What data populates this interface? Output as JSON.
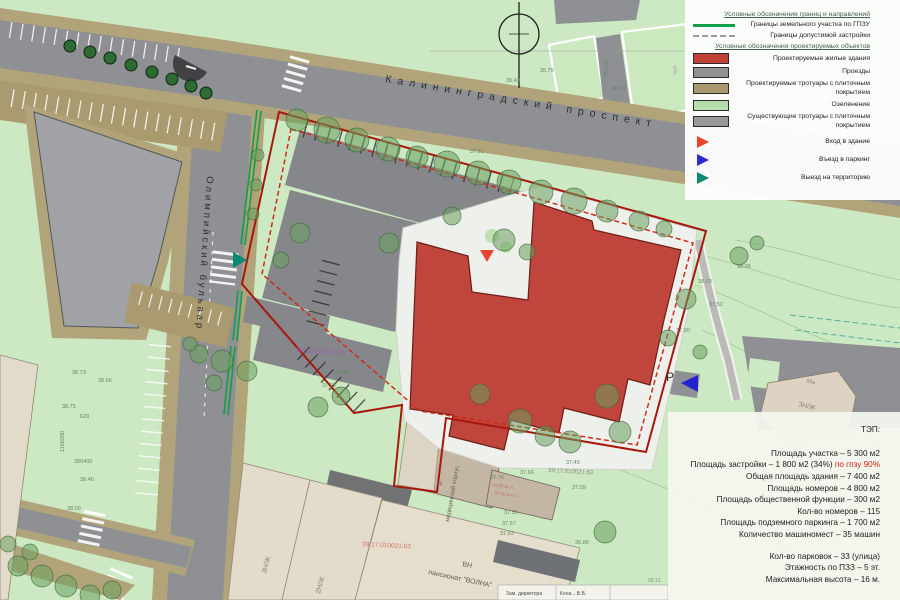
{
  "legend": {
    "header_borders": "Условные обозначения границ и направлений",
    "borders": [
      {
        "label": "Границы земельного участка по ГПЗУ",
        "swatch": "line-green",
        "name": "green-line-swatch"
      },
      {
        "label": "Границы допустимой застройки",
        "swatch": "line-dashed",
        "name": "dashed-line-swatch"
      }
    ],
    "header_objects": "Условные обозначения проектируемых объектов",
    "objects": [
      {
        "label": "Проектируемые жилые здания",
        "color": "#bf4136",
        "name": "red-building-swatch"
      },
      {
        "label": "Проезды",
        "color": "#8f9193",
        "name": "driveway-swatch"
      },
      {
        "label": "Проектируемые тротуары с плиточным покрытием",
        "color": "#a89a6f",
        "name": "new-sidewalk-swatch"
      },
      {
        "label": "Озеленение",
        "color": "#b5deac",
        "name": "greenery-swatch"
      },
      {
        "label": "Существующие тротуары с плиточным покрытием",
        "color": "#97999b",
        "name": "existing-sidewalk-swatch"
      }
    ],
    "markers": [
      {
        "label": "Вход в здание",
        "color": "#e8432c",
        "name": "building-entrance-icon"
      },
      {
        "label": "Въезд в паркинг",
        "color": "#2a2ad6",
        "name": "parking-entrance-icon"
      },
      {
        "label": "Выезд на территорию",
        "color": "#0b8a74",
        "name": "territory-exit-icon"
      }
    ]
  },
  "tep": {
    "title": "ТЭП:",
    "block1": [
      {
        "t": "Площадь участка – 5 300 м2"
      },
      {
        "t": "Площадь застройки – 1 800 м2 (34%)",
        "a": " по гпзу 90%"
      },
      {
        "t": "Общая площадь здания – 7 400 м2"
      },
      {
        "t": "Площадь номеров – 4 800 м2"
      },
      {
        "t": "Площадь общественной функции – 300 м2"
      },
      {
        "t": "Кол-во номеров – 115"
      },
      {
        "t": "Площадь подземного паркинга – 1 700 м2"
      },
      {
        "t": "Количество машиномест – 35 машин"
      }
    ],
    "block2": [
      {
        "t": "Кол-во парковок – 33 (улица)"
      },
      {
        "t": "Этажность по ПЗЗ – 5 эт."
      },
      {
        "t": "Максимальная высота – 16 м."
      }
    ]
  },
  "map": {
    "colors": {
      "background_green": "#cde9c3",
      "road_gray": "#8e9093",
      "sidewalk_tan": "#b2a47a",
      "projected_building_red": "#c0453c",
      "boundary_solid_red": "#a8170c",
      "boundary_dashed_red": "#d02a18",
      "gpzu_green_line": "#12a047"
    },
    "annotations": [
      {
        "t": "Калининградский проспект",
        "x": 385,
        "y": 82,
        "r": 9.5,
        "s": 10.5,
        "c": "#2e2e2e",
        "ls": 6
      },
      {
        "t": "Олимпийский бульвар",
        "x": 207,
        "y": 176,
        "r": 94,
        "s": 9.5,
        "c": "#2e2e2e",
        "ls": 3
      },
      {
        "t": "ВН",
        "x": 462,
        "y": 566,
        "r": 12,
        "s": 7,
        "c": "#5a5a52"
      },
      {
        "t": "пансионат \"ВОЛНА\"",
        "x": 428,
        "y": 574,
        "r": 12,
        "s": 7,
        "c": "#5a5a52"
      },
      {
        "t": "медицинский корпус",
        "x": 449,
        "y": 522,
        "r": -80,
        "s": 6,
        "c": "#6a6258"
      },
      {
        "t": "Н",
        "x": 437,
        "y": 486,
        "r": 0,
        "s": 7,
        "c": "#6a6258"
      },
      {
        "t": "3Н/Ж",
        "x": 266,
        "y": 574,
        "r": -75,
        "s": 7,
        "c": "#8a8276"
      },
      {
        "t": "2Н/Ж",
        "x": 320,
        "y": 594,
        "r": -75,
        "s": 7,
        "c": "#8a8276"
      },
      {
        "t": "3Н/Ж",
        "x": 798,
        "y": 406,
        "r": 14,
        "s": 7,
        "c": "#8a8276"
      },
      {
        "t": "68а",
        "x": 806,
        "y": 382,
        "r": 14,
        "s": 5.5,
        "c": "#8a8276"
      },
      {
        "t": "77о",
        "x": 672,
        "y": 66,
        "r": 75,
        "s": 5,
        "c": "#8a8276"
      },
      {
        "t": "P",
        "x": 666,
        "y": 381,
        "r": 0,
        "s": 12,
        "c": "#2d2d2d"
      },
      {
        "t": "39:17:010021:63",
        "x": 296,
        "y": 352,
        "r": 3,
        "s": 6.5,
        "c": "#a05cb5"
      },
      {
        "t": "39:17:010021:63",
        "x": 362,
        "y": 546,
        "r": 3,
        "s": 6.5,
        "c": "#cf7468"
      },
      {
        "t": "39:17:010021:63",
        "x": 548,
        "y": 472,
        "r": 3,
        "s": 6,
        "c": "#8b8b85"
      },
      {
        "t": "кар 200",
        "x": 606,
        "y": 78,
        "r": -83,
        "s": 5,
        "c": "#5f8760"
      },
      {
        "t": "35.79",
        "x": 540,
        "y": 72,
        "s": 5.5,
        "c": "#5f8760"
      },
      {
        "t": "35.43",
        "x": 506,
        "y": 82,
        "s": 5.5,
        "c": "#5f8760"
      },
      {
        "t": "38.21",
        "x": 612,
        "y": 90,
        "s": 5.5,
        "c": "#5f8760"
      },
      {
        "t": "37.31",
        "x": 470,
        "y": 153,
        "s": 5.5,
        "c": "#5f8760"
      },
      {
        "t": "38.06",
        "x": 737,
        "y": 268,
        "s": 5.5,
        "c": "#5f8760"
      },
      {
        "t": "38.03",
        "x": 698,
        "y": 283,
        "s": 5.5,
        "c": "#5f8760"
      },
      {
        "t": "37.52",
        "x": 709,
        "y": 306,
        "s": 5.5,
        "c": "#5f8760"
      },
      {
        "t": "37.90",
        "x": 676,
        "y": 332,
        "s": 5.5,
        "c": "#5f8760"
      },
      {
        "t": "38.73",
        "x": 72,
        "y": 374,
        "s": 5.5,
        "c": "#5f8760"
      },
      {
        "t": "38.66",
        "x": 98,
        "y": 382,
        "s": 5.5,
        "c": "#5f8760"
      },
      {
        "t": "38.75",
        "x": 62,
        "y": 408,
        "s": 5.5,
        "c": "#5f8760"
      },
      {
        "t": "629",
        "x": 80,
        "y": 418,
        "s": 5.5,
        "c": "#5f8760"
      },
      {
        "t": "38.46",
        "x": 80,
        "y": 481,
        "s": 5.5,
        "c": "#5f8760"
      },
      {
        "t": "38.09",
        "x": 67,
        "y": 510,
        "s": 5.5,
        "c": "#5f8760"
      },
      {
        "t": "38.06",
        "x": 334,
        "y": 374,
        "s": 5.5,
        "c": "#5f8760"
      },
      {
        "t": "37.93",
        "x": 322,
        "y": 387,
        "s": 5.5,
        "c": "#5f8760"
      },
      {
        "t": "37.76",
        "x": 490,
        "y": 479,
        "s": 5.5,
        "c": "#5f8760"
      },
      {
        "t": "37.66",
        "x": 520,
        "y": 474,
        "s": 5.5,
        "c": "#5f8760"
      },
      {
        "t": "37.45",
        "x": 566,
        "y": 464,
        "s": 5.5,
        "c": "#5f8760"
      },
      {
        "t": "37.09",
        "x": 572,
        "y": 489,
        "s": 5.5,
        "c": "#5f8760"
      },
      {
        "t": "37.59",
        "x": 504,
        "y": 514,
        "s": 5.5,
        "c": "#5f8760"
      },
      {
        "t": "37.57",
        "x": 502,
        "y": 525,
        "s": 5.5,
        "c": "#5f8760"
      },
      {
        "t": "37.63",
        "x": 500,
        "y": 535,
        "s": 5.5,
        "c": "#5f8760"
      },
      {
        "t": "36.86",
        "x": 575,
        "y": 544,
        "s": 5.5,
        "c": "#5f8760"
      },
      {
        "t": "38.08 вх.л.",
        "x": 492,
        "y": 486,
        "r": 8,
        "s": 4.5,
        "c": "#cc7266"
      },
      {
        "t": "35.96 вых.л.",
        "x": 494,
        "y": 494,
        "r": 8,
        "s": 4.5,
        "c": "#cc7266"
      },
      {
        "t": "1166200",
        "x": 64,
        "y": 452,
        "r": -90,
        "s": 5.5,
        "c": "#5f8760"
      },
      {
        "t": "380400",
        "x": 74,
        "y": 463,
        "s": 5.5,
        "c": "#5f8760"
      },
      {
        "t": "Зам. директора",
        "x": 506,
        "y": 595,
        "s": 5,
        "c": "#4a4a44"
      },
      {
        "t": "Кона... В.В.",
        "x": 560,
        "y": 595,
        "s": 5,
        "c": "#4a4a44"
      },
      {
        "t": "06.12.",
        "x": 648,
        "y": 582,
        "s": 5,
        "c": "#7b9a7b"
      }
    ],
    "markers": [
      {
        "name": "building-entrance-marker",
        "color": "#e8432c",
        "points": "480,250 494,250 487,262"
      },
      {
        "name": "parking-entrance-marker",
        "color": "#2323cf",
        "points": "698,375 698,392 681,383"
      },
      {
        "name": "territory-exit-marker",
        "color": "#0b8a74",
        "points": "233,252 233,268 247,260"
      }
    ]
  }
}
